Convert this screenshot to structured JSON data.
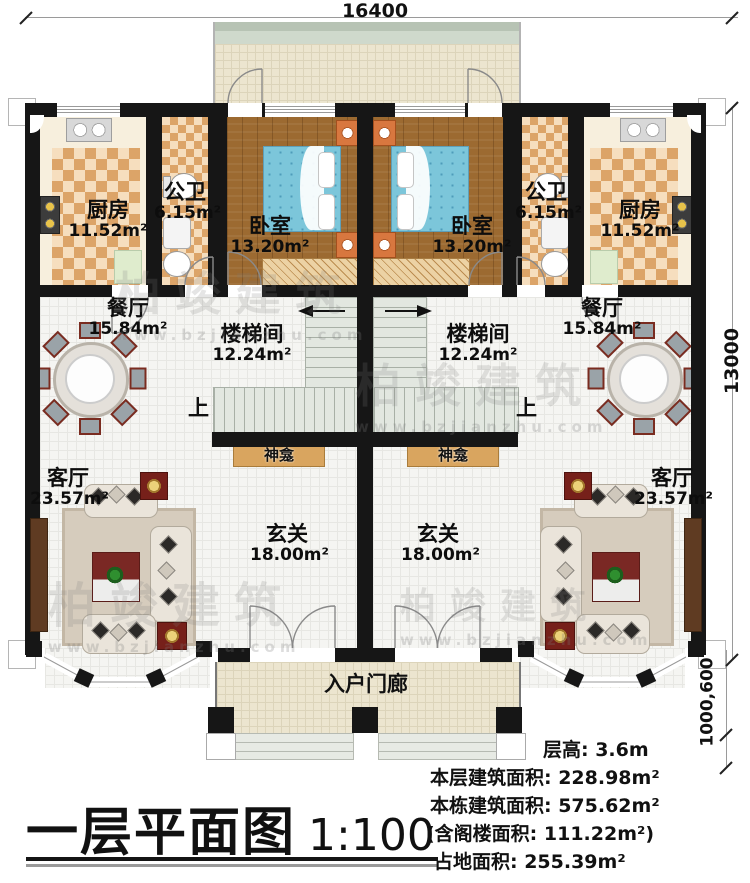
{
  "plan": {
    "title": "一层平面图",
    "scale": "1:100",
    "dim_top": "16400",
    "dim_right": "13000",
    "dim_right_lower": "1000,600",
    "up_label": "上"
  },
  "rooms": {
    "kitchen": {
      "name": "厨房",
      "area": "11.52m²"
    },
    "bath": {
      "name": "公卫",
      "area": "6.15m²"
    },
    "bedroom": {
      "name": "卧室",
      "area": "13.20m²"
    },
    "dining": {
      "name": "餐厅",
      "area": "15.84m²"
    },
    "stairwell": {
      "name": "楼梯间",
      "area": "12.24m²"
    },
    "living": {
      "name": "客厅",
      "area": "23.57m²"
    },
    "foyer": {
      "name": "玄关",
      "area": "18.00m²"
    },
    "shrine": "神龛",
    "porch": "入户门廊"
  },
  "info": {
    "floor_height": "层高: 3.6m",
    "floor_area": "本层建筑面积: 228.98m²",
    "building_area": "本栋建筑面积: 575.62m²",
    "attic_area": "(含阁楼面积: 111.22m²)",
    "land_area": "占地面积: 255.39m²"
  },
  "watermark": {
    "brand": "柏竣建筑",
    "site": "www.bzjianzhu.com"
  },
  "colors": {
    "wall": "#161616",
    "checker": "#dca468",
    "wood": "#9c6a31",
    "bed": "#7cc6da",
    "shrine": "#d9a55f",
    "stair": "#e2e7e0"
  }
}
